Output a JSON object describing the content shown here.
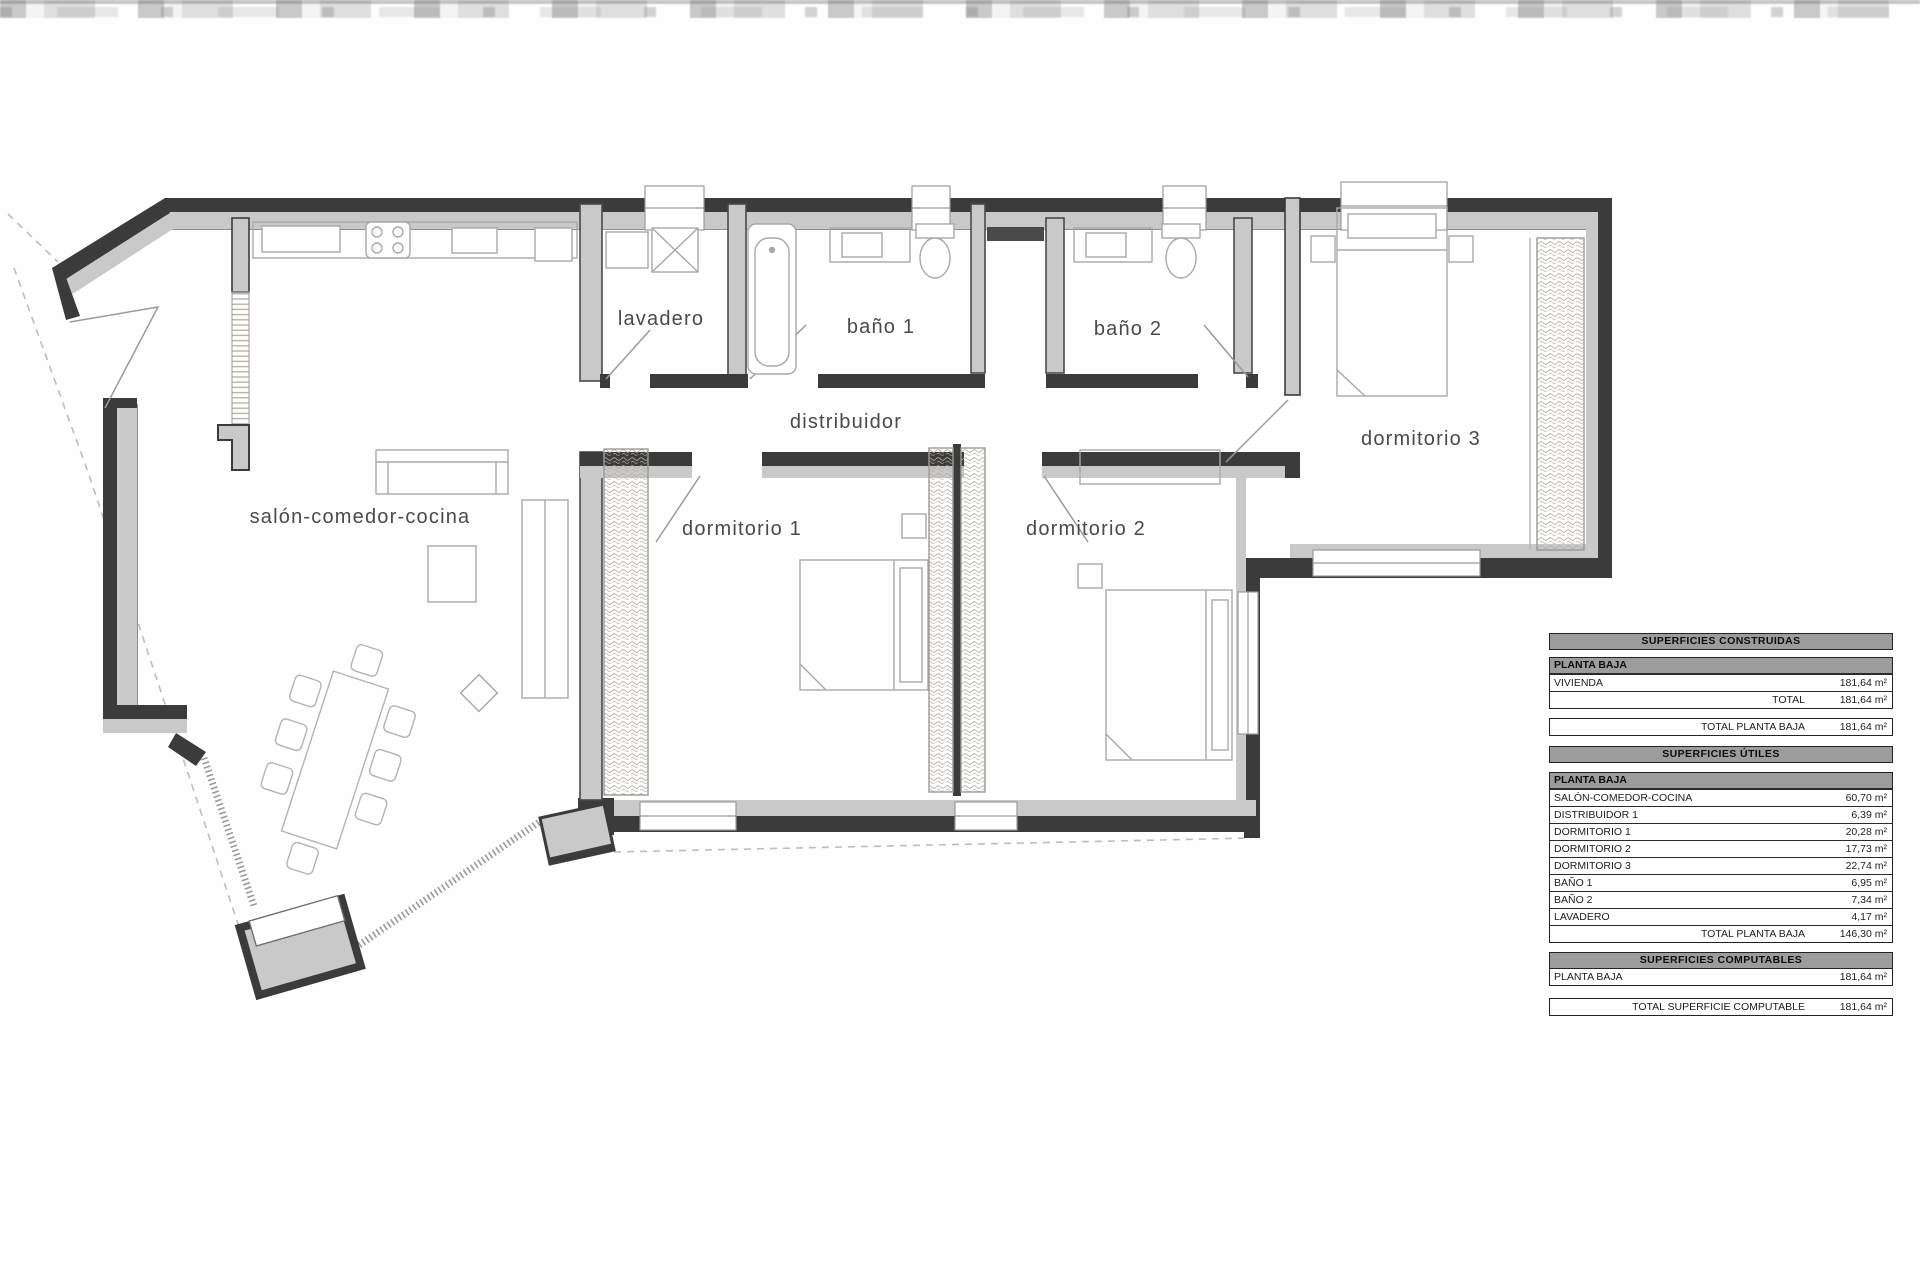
{
  "plan": {
    "rooms": [
      {
        "id": "salon",
        "label": "salón-comedor-cocina"
      },
      {
        "id": "lavadero",
        "label": "lavadero"
      },
      {
        "id": "bano1",
        "label": "baño 1"
      },
      {
        "id": "bano2",
        "label": "baño 2"
      },
      {
        "id": "distribuidor",
        "label": "distribuidor"
      },
      {
        "id": "dormitorio1",
        "label": "dormitorio 1"
      },
      {
        "id": "dormitorio2",
        "label": "dormitorio 2"
      },
      {
        "id": "dormitorio3",
        "label": "dormitorio 3"
      }
    ],
    "colors": {
      "wall": "#3b3b3b",
      "wall_fill": "#c9c9c9",
      "furniture": "#a8a8a8",
      "label": "#4a4a4a",
      "wardrobe_hatch": "#b3ab9c",
      "dashed_boundary": "#bdbdbd"
    }
  },
  "area_table": {
    "constructed": {
      "title": "SUPERFICIES CONSTRUIDAS",
      "subheader": "PLANTA BAJA",
      "rows": [
        {
          "label": "VIVIENDA",
          "value": "181,64 m²"
        },
        {
          "label": "TOTAL",
          "value": "181,64 m²"
        }
      ],
      "total": {
        "label": "TOTAL PLANTA BAJA",
        "value": "181,64 m²"
      }
    },
    "useful": {
      "title": "SUPERFICIES ÚTILES",
      "subheader": "PLANTA BAJA",
      "rows": [
        {
          "label": "SALÓN-COMEDOR-COCINA",
          "value": "60,70 m²"
        },
        {
          "label": "DISTRIBUIDOR 1",
          "value": "6,39 m²"
        },
        {
          "label": "DORMITORIO 1",
          "value": "20,28 m²"
        },
        {
          "label": "DORMITORIO 2",
          "value": "17,73 m²"
        },
        {
          "label": "DORMITORIO 3",
          "value": "22,74 m²"
        },
        {
          "label": "BAÑO 1",
          "value": "6,95 m²"
        },
        {
          "label": "BAÑO 2",
          "value": "7,34 m²"
        },
        {
          "label": "LAVADERO",
          "value": "4,17 m²"
        }
      ],
      "total": {
        "label": "TOTAL PLANTA BAJA",
        "value": "146,30 m²"
      }
    },
    "computable": {
      "title": "SUPERFICIES COMPUTABLES",
      "rows": [
        {
          "label": "PLANTA BAJA",
          "value": "181,64 m²"
        }
      ],
      "total": {
        "label": "TOTAL SUPERFICIE COMPUTABLE",
        "value": "181,64 m²"
      }
    }
  }
}
